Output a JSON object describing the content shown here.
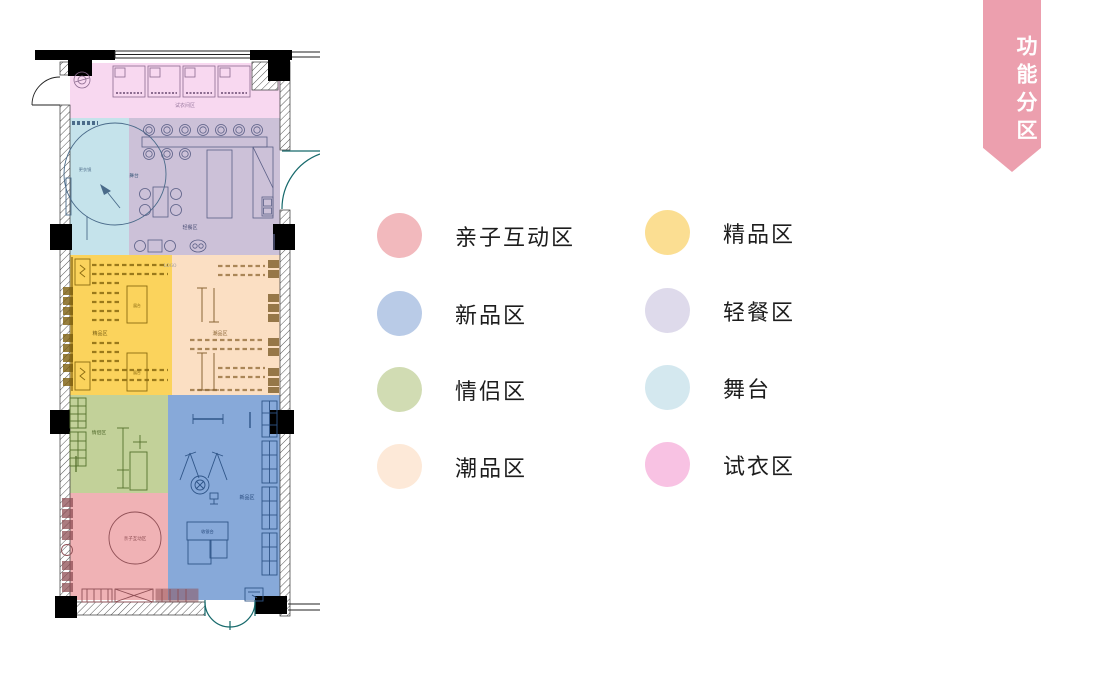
{
  "ribbon": {
    "label": "功能分区",
    "color": "#ec9fae"
  },
  "legend": {
    "items": [
      {
        "label": "亲子互动区",
        "color": "#f2b9bd"
      },
      {
        "label": "新品区",
        "color": "#b9cbe7"
      },
      {
        "label": "情侣区",
        "color": "#d1dcb3"
      },
      {
        "label": "潮品区",
        "color": "#fde9d8"
      },
      {
        "label": "精品区",
        "color": "#fbde92"
      },
      {
        "label": "轻餐区",
        "color": "#dedaeb"
      },
      {
        "label": "舞台",
        "color": "#d4e8ef"
      },
      {
        "label": "试衣区",
        "color": "#f8c2e3"
      }
    ]
  },
  "floor_plan": {
    "zones": [
      {
        "name": "试衣区",
        "plan_label": "试衣间区",
        "color": "#f8d8f0"
      },
      {
        "name": "舞台",
        "plan_label": "舞台",
        "color": "#c5e3eb"
      },
      {
        "name": "轻餐区",
        "plan_label": "轻餐区",
        "color": "#ccc1d8"
      },
      {
        "name": "精品区",
        "plan_label": "精品区",
        "color": "#fbd35c"
      },
      {
        "name": "潮品区",
        "plan_label": "潮品区",
        "color": "#fbdfc3"
      },
      {
        "name": "情侣区",
        "plan_label": "情侣区",
        "color": "#c2d199"
      },
      {
        "name": "新品区",
        "plan_label": "新品区",
        "color": "#87a9d9"
      },
      {
        "name": "亲子互动区",
        "plan_label": "亲子互动区",
        "color": "#f0b2b5"
      }
    ],
    "annotations": {
      "logo": "LOGO",
      "cashier": "收银台",
      "stand_a": "展台",
      "stand_b": "展台",
      "mirror": "更衣镜"
    }
  }
}
